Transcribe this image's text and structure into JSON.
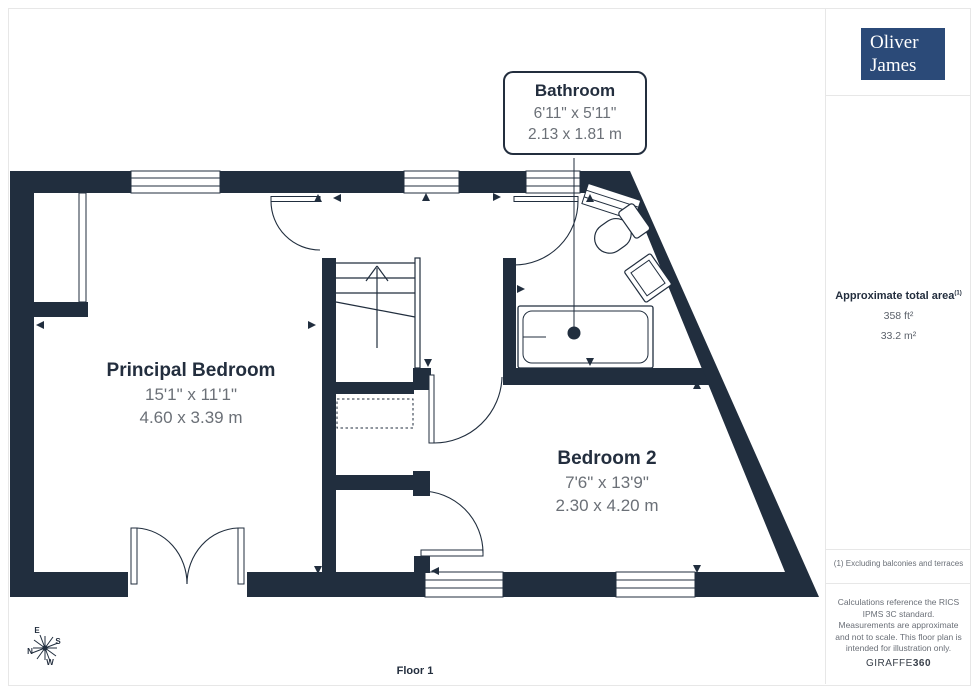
{
  "branding": {
    "logo_line1": "Oliver",
    "logo_line2": "James",
    "footer_brand_normal": "GIRAFFE",
    "footer_brand_bold": "360"
  },
  "sidebar": {
    "area_title": "Approximate total area",
    "area_note_ref": "(1)",
    "area_ft": "358 ft²",
    "area_m": "33.2 m²",
    "footnote": "(1) Excluding balconies and terraces",
    "disclaimer": "Calculations reference the RICS IPMS 3C standard. Measurements are approximate and not to scale. This floor plan is intended for illustration only."
  },
  "floor_label": "Floor 1",
  "rooms": {
    "principal_bedroom": {
      "name": "Principal Bedroom",
      "imperial": "15'1\" x 11'1\"",
      "metric": "4.60 x 3.39 m"
    },
    "bedroom2": {
      "name": "Bedroom 2",
      "imperial": "7'6\" x 13'9\"",
      "metric": "2.30 x 4.20 m"
    },
    "bathroom": {
      "name": "Bathroom",
      "imperial": "6'11\" x 5'11\"",
      "metric": "2.13 x 1.81 m"
    }
  },
  "compass": {
    "n": "N",
    "e": "E",
    "s": "S",
    "w": "W"
  },
  "colors": {
    "wall": "#212e3e",
    "label_dark": "#232e3e",
    "dim_gray": "#6b7077",
    "logo_bg": "#2b4a78",
    "divider": "#e7e7e7"
  }
}
